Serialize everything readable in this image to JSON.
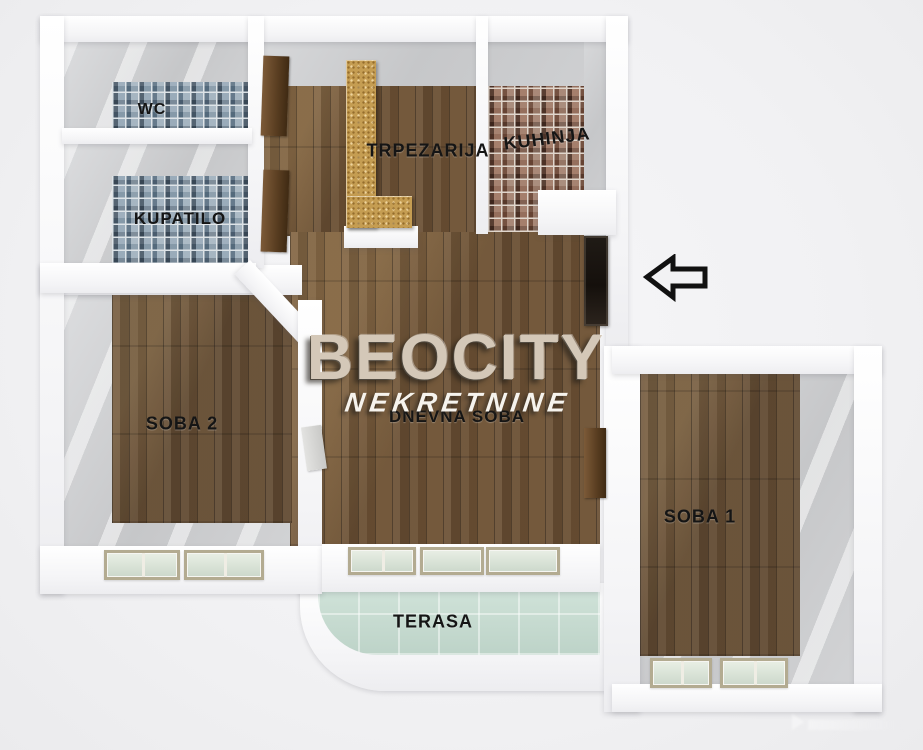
{
  "plan": {
    "type": "apartment-floor-plan",
    "view": "3d-top-down"
  },
  "rooms": {
    "wc": {
      "label": "WC"
    },
    "kupatilo": {
      "label": "KUPATILO"
    },
    "trpezarija": {
      "label": "TRPEZARIJA"
    },
    "kuhinja": {
      "label": "KUHINJA"
    },
    "soba2": {
      "label": "SOBA 2"
    },
    "dnevna_soba": {
      "label": "DNEVNA SOBA"
    },
    "soba1": {
      "label": "SOBA 1"
    },
    "terasa": {
      "label": "TERASA"
    }
  },
  "watermark": {
    "brand": "BEOCITY",
    "subtitle": "NEKRETNINE"
  },
  "icons": {
    "entrance_arrow": "arrow-left"
  },
  "colors": {
    "background": "#f2f2f4",
    "wall": "#fbfbfc",
    "wood_floor": "#6b5034",
    "bath_tile": "#8d9aa6",
    "kitchen_tile": "#7b5a49",
    "terrace_tile": "#c7dbd1",
    "label_text": "#151515",
    "watermark_brand": "#d4c8b8",
    "watermark_subtitle": "#f6f3ed",
    "arrow_outline": "#111111",
    "entrance_door": "#17120d"
  }
}
